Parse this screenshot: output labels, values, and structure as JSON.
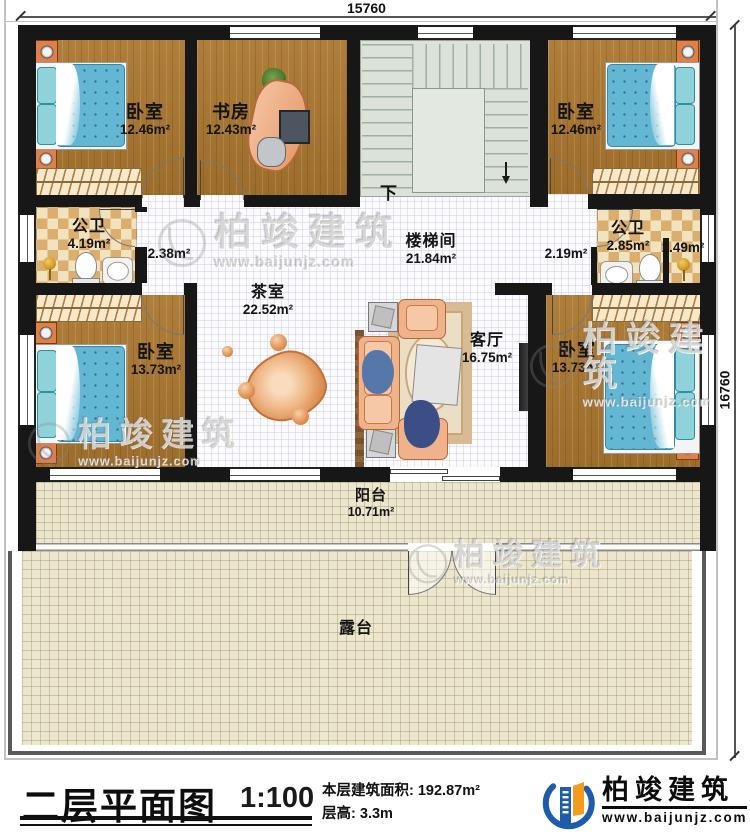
{
  "dimensions": {
    "width_top": "15760",
    "height_right": "16760"
  },
  "stairs": {
    "down_label": "下"
  },
  "rooms": {
    "bedroom_tl": {
      "name": "卧室",
      "area": "12.46m²"
    },
    "study": {
      "name": "书房",
      "area": "12.43m²"
    },
    "bedroom_tr": {
      "name": "卧室",
      "area": "12.46m²"
    },
    "bath_left": {
      "name": "公卫",
      "area": "4.19m²"
    },
    "hall_left": {
      "area": "2.38m²"
    },
    "stairwell": {
      "name": "楼梯间",
      "area": "21.84m²"
    },
    "hall_right": {
      "area": "2.19m²"
    },
    "bath_right": {
      "name": "公卫",
      "area": "2.85m²"
    },
    "shower_right": {
      "area": "1.49m²"
    },
    "bedroom_bl": {
      "name": "卧室",
      "area": "13.73m²"
    },
    "tea_room": {
      "name": "茶室",
      "area": "22.52m²"
    },
    "living_room": {
      "name": "客厅",
      "area": "16.75m²"
    },
    "bedroom_br": {
      "name": "卧室",
      "area": "13.73m²"
    },
    "balcony": {
      "name": "阳台",
      "area": "10.71m²"
    },
    "terrace": {
      "name": "露台"
    }
  },
  "title_block": {
    "title": "二层平面图",
    "scale": "1:100",
    "area_label": "本层建筑面积:",
    "area_value": "192.87m²",
    "height_label": "层高:",
    "height_value": "3.3m"
  },
  "logo": {
    "name": "柏竣建筑",
    "website": "www.baijunjz.com"
  },
  "watermark": {
    "brand": "柏竣建筑",
    "website": "www.baijunjz.com"
  },
  "colors": {
    "wall": "#171717",
    "wood_floor": "#aa762f",
    "tile_light": "#f2e3c0",
    "tile_dark": "#dcae6e",
    "mattress_blue": "#64b7d2",
    "logo_blue": "#1d5bad",
    "logo_orange": "#f29b1d"
  }
}
